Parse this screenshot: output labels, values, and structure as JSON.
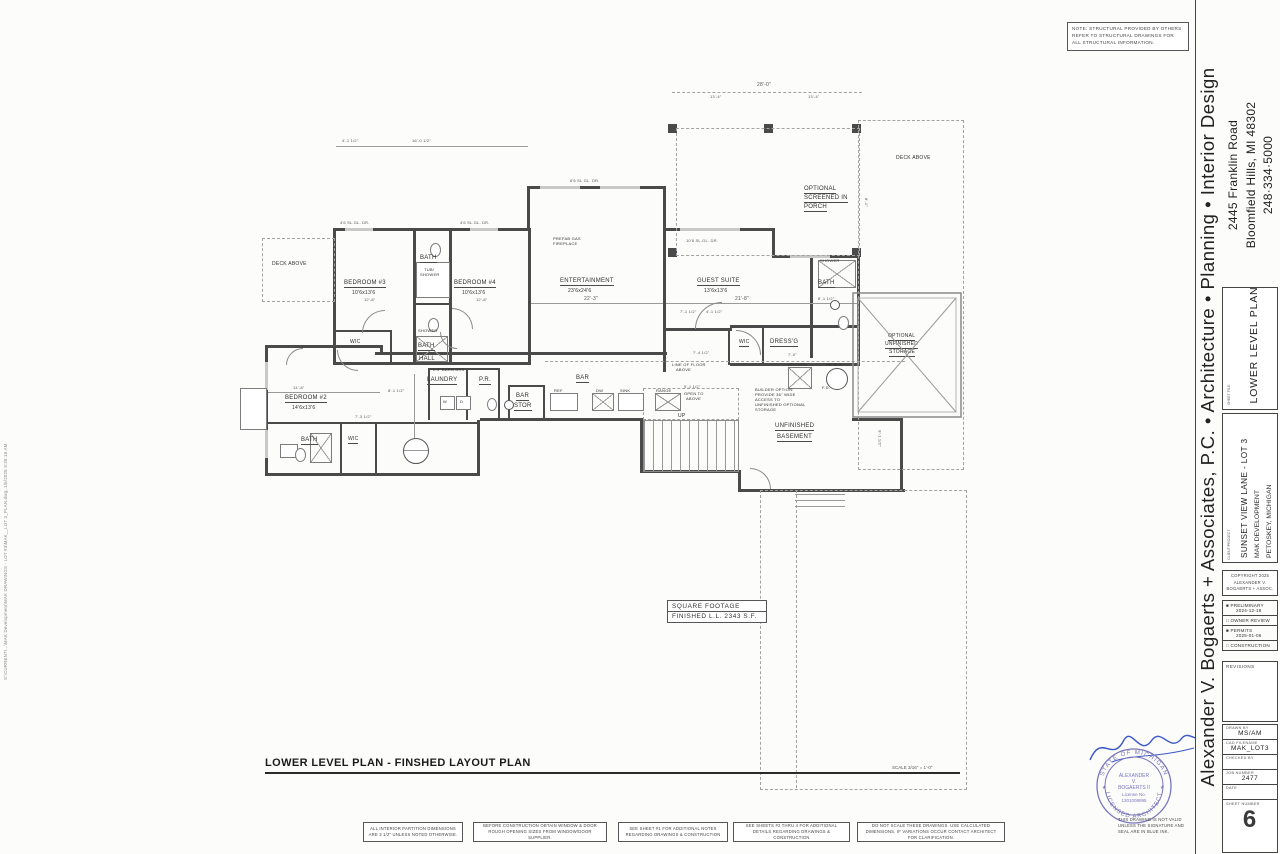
{
  "sheet": {
    "structural_note": "NOTE: STRUCTURAL PROVIDED BY OTHERS. REFER TO STRUCTURAL DRAWINGS FOR ALL STRUCTURAL INFORMATION.",
    "plan_title": "LOWER LEVEL PLAN - FINSHED LAYOUT PLAN",
    "scale_note": "SCALE 3/16\" = 1'-0\"",
    "file_path": "S:\\CURRENT\\...\\MAK Development\\MAK DRAWINGS - LOT #3\\MAK__LOT 3_PLAN.dwg, 1/6/2025 9:35:18 AM",
    "square_footage": {
      "line1": "SQUARE FOOTAGE",
      "line2": "FINISHED L.L.   2343 S.F."
    },
    "general_notes": [
      "ALL INTERIOR PARTITION DIMENSIONS ARE 3 1/2\" UNLESS NOTED OTHERWISE.",
      "BEFORE CONSTRUCTION OBTAIN WINDOW & DOOR ROUGH OPENING SIZES FROM WINDOW/DOOR SUPPLIER.",
      "SEE SHEET #1 FOR ADDITIONAL NOTES REGARDING DRAWINGS & CONSTRUCTION",
      "SEE SHEETS #2 THRU 4 FOR ADDITIONAL DETAILS REGARDING DRAWINGS & CONSTRUCTION",
      "DO NOT SCALE THESE DRAWINGS. USE CALCULATED DIMENSIONS. IF VARIATIONS OCCUR CONTACT ARCHITECT FOR CLARIFICATION."
    ]
  },
  "plan": {
    "labels": [
      {
        "text": "DECK ABOVE",
        "x": 272,
        "y": 262,
        "s": 5
      },
      {
        "text": "BEDROOM #3",
        "x": 344,
        "y": 280,
        "s": 6,
        "u": true
      },
      {
        "text": "10'6x13'6",
        "x": 352,
        "y": 291,
        "s": 5
      },
      {
        "text": "BATH",
        "x": 420,
        "y": 255,
        "s": 6,
        "u": true
      },
      {
        "text": "TUB/",
        "x": 424,
        "y": 268,
        "s": 4
      },
      {
        "text": "SHOWER",
        "x": 420,
        "y": 273,
        "s": 4
      },
      {
        "text": "BEDROOM #4",
        "x": 454,
        "y": 280,
        "s": 6,
        "u": true
      },
      {
        "text": "10'6x13'6",
        "x": 462,
        "y": 291,
        "s": 5
      },
      {
        "text": "WIC",
        "x": 350,
        "y": 340,
        "s": 5,
        "u": true
      },
      {
        "text": "SHOWER",
        "x": 418,
        "y": 329,
        "s": 4
      },
      {
        "text": "BATH",
        "x": 418,
        "y": 343,
        "s": 6,
        "u": true
      },
      {
        "text": "PREFAB GAS",
        "x": 553,
        "y": 237,
        "s": 4
      },
      {
        "text": "FIREPLACE",
        "x": 553,
        "y": 242,
        "s": 4
      },
      {
        "text": "ENTERTAINMENT",
        "x": 560,
        "y": 278,
        "s": 6,
        "u": true
      },
      {
        "text": "23'6x24'6",
        "x": 568,
        "y": 289,
        "s": 5
      },
      {
        "text": "GUEST SUITE",
        "x": 697,
        "y": 278,
        "s": 6,
        "u": true
      },
      {
        "text": "13'6x13'6",
        "x": 704,
        "y": 289,
        "s": 5
      },
      {
        "text": "SHOWER",
        "x": 820,
        "y": 259,
        "s": 4
      },
      {
        "text": "BATH",
        "x": 818,
        "y": 280,
        "s": 6,
        "u": true
      },
      {
        "text": "WIC",
        "x": 739,
        "y": 340,
        "s": 5,
        "u": true
      },
      {
        "text": "DRESS'G",
        "x": 770,
        "y": 339,
        "s": 6,
        "u": true
      },
      {
        "text": "OPTIONAL",
        "x": 804,
        "y": 186,
        "s": 6,
        "u": true
      },
      {
        "text": "SCREENED IN",
        "x": 804,
        "y": 195,
        "s": 6,
        "u": true
      },
      {
        "text": "PORCH",
        "x": 804,
        "y": 204,
        "s": 6,
        "u": true
      },
      {
        "text": "DECK ABOVE",
        "x": 896,
        "y": 156,
        "s": 5
      },
      {
        "text": "OPTIONAL",
        "x": 888,
        "y": 334,
        "s": 5,
        "u": true
      },
      {
        "text": "UNFINISHED",
        "x": 885,
        "y": 342,
        "s": 5,
        "u": true
      },
      {
        "text": "STORAGE",
        "x": 889,
        "y": 350,
        "s": 5,
        "u": true
      },
      {
        "text": "BEDROOM #2",
        "x": 285,
        "y": 395,
        "s": 6,
        "u": true
      },
      {
        "text": "14'6x13'6",
        "x": 292,
        "y": 406,
        "s": 5
      },
      {
        "text": "BATH",
        "x": 301,
        "y": 437,
        "s": 6,
        "u": true
      },
      {
        "text": "WIC",
        "x": 348,
        "y": 437,
        "s": 5,
        "u": true
      },
      {
        "text": "HALL",
        "x": 419,
        "y": 356,
        "s": 6,
        "u": true
      },
      {
        "text": "2-3' BARN DRS",
        "x": 433,
        "y": 368,
        "s": 4
      },
      {
        "text": "LAUNDRY",
        "x": 427,
        "y": 377,
        "s": 6,
        "u": true
      },
      {
        "text": "P.R.",
        "x": 479,
        "y": 377,
        "s": 6,
        "u": true
      },
      {
        "text": "BAR",
        "x": 576,
        "y": 375,
        "s": 6,
        "u": true
      },
      {
        "text": "BAR",
        "x": 516,
        "y": 393,
        "s": 6,
        "u": true
      },
      {
        "text": "STOR",
        "x": 514,
        "y": 403,
        "s": 6,
        "u": true
      },
      {
        "text": "REF",
        "x": 554,
        "y": 389,
        "s": 4
      },
      {
        "text": "DW",
        "x": 596,
        "y": 389,
        "s": 4
      },
      {
        "text": "SINK",
        "x": 620,
        "y": 389,
        "s": 4
      },
      {
        "text": "RANGE",
        "x": 656,
        "y": 389,
        "s": 4
      },
      {
        "text": "W",
        "x": 443,
        "y": 400,
        "s": 4
      },
      {
        "text": "D",
        "x": 460,
        "y": 400,
        "s": 4
      },
      {
        "text": "LINE OF FLOOR",
        "x": 672,
        "y": 363,
        "s": 4
      },
      {
        "text": "ABOVE",
        "x": 676,
        "y": 368,
        "s": 4
      },
      {
        "text": "OPEN TO",
        "x": 684,
        "y": 392,
        "s": 4
      },
      {
        "text": "ABOVE",
        "x": 686,
        "y": 397,
        "s": 4
      },
      {
        "text": "UP",
        "x": 678,
        "y": 414,
        "s": 5
      },
      {
        "text": "HE FURN",
        "x": 788,
        "y": 363,
        "s": 4
      },
      {
        "text": "HE W.H.",
        "x": 826,
        "y": 363,
        "s": 4
      },
      {
        "text": "F.D.",
        "x": 822,
        "y": 386,
        "s": 4
      },
      {
        "text": "BUILDER OPTION:",
        "x": 755,
        "y": 388,
        "s": 4
      },
      {
        "text": "PROVIDE 36\" WIDE",
        "x": 755,
        "y": 393,
        "s": 4
      },
      {
        "text": "ACCESS TO",
        "x": 755,
        "y": 398,
        "s": 4
      },
      {
        "text": "UNFINISHED OPTIONAL",
        "x": 755,
        "y": 403,
        "s": 4
      },
      {
        "text": "STORAGE",
        "x": 755,
        "y": 408,
        "s": 4
      },
      {
        "text": "UNFINISHED",
        "x": 775,
        "y": 423,
        "s": 6,
        "u": true
      },
      {
        "text": "BASEMENT",
        "x": 777,
        "y": 434,
        "s": 6,
        "u": true
      }
    ],
    "dimensions": [
      {
        "text": "28'-0\"",
        "x": 757,
        "y": 82,
        "s": 5
      },
      {
        "text": "13'-4\"",
        "x": 710,
        "y": 94,
        "s": 4
      },
      {
        "text": "13'-4\"",
        "x": 808,
        "y": 94,
        "s": 4
      },
      {
        "text": "4'-1 1/2\"",
        "x": 342,
        "y": 138,
        "s": 4
      },
      {
        "text": "16'-0 1/2\"",
        "x": 412,
        "y": 138,
        "s": 4
      },
      {
        "text": "4'6 SL.GL. DR.",
        "x": 340,
        "y": 220,
        "s": 4
      },
      {
        "text": "4'6 SL.GL. DR.",
        "x": 460,
        "y": 220,
        "s": 4
      },
      {
        "text": "8'6 SL.GL. DR.",
        "x": 570,
        "y": 178,
        "s": 4
      },
      {
        "text": "10'6 SL.GL. DR.",
        "x": 686,
        "y": 238,
        "s": 4
      },
      {
        "text": "22'-3\"",
        "x": 584,
        "y": 296,
        "s": 5
      },
      {
        "text": "21'-8\"",
        "x": 735,
        "y": 296,
        "s": 5
      },
      {
        "text": "8'-1 1/2\"",
        "x": 818,
        "y": 296,
        "s": 4
      },
      {
        "text": "7'-1 1/2\"",
        "x": 680,
        "y": 309,
        "s": 4
      },
      {
        "text": "4'-1 1/2\"",
        "x": 706,
        "y": 309,
        "s": 4
      },
      {
        "text": "7'-4 1/2\"",
        "x": 693,
        "y": 350,
        "s": 4
      },
      {
        "text": "7'-0\"",
        "x": 788,
        "y": 352,
        "s": 4
      },
      {
        "text": "12'-8\"",
        "x": 364,
        "y": 297,
        "s": 4
      },
      {
        "text": "12'-8\"",
        "x": 476,
        "y": 297,
        "s": 4
      },
      {
        "text": "14'-8\"",
        "x": 293,
        "y": 385,
        "s": 4
      },
      {
        "text": "8'-1 1/2\"",
        "x": 388,
        "y": 388,
        "s": 4
      },
      {
        "text": "7'-3 1/2\"",
        "x": 355,
        "y": 414,
        "s": 4
      },
      {
        "text": "5'-1 1/2\"",
        "x": 684,
        "y": 384,
        "s": 4
      },
      {
        "text": "8'-1 1/2\"",
        "x": 872,
        "y": 436,
        "s": 4,
        "rot": 90
      },
      {
        "text": "8'-1\"",
        "x": 862,
        "y": 200,
        "s": 4,
        "rot": 90
      }
    ]
  },
  "title_block": {
    "firm_name": "Alexander V. Bogaerts + Associates, P.C.  •  Architecture  •  Planning  •  Interior Design",
    "address_line1": "2445 Franklin Road",
    "address_line2": "Bloomfield Hills, MI 48302",
    "phone": "248·334·5000",
    "sheet_file_label": "SHEET FILE",
    "sheet_file": "LOWER LEVEL PLAN",
    "client_label": "CLIENT/PROJECT",
    "project_name": "SUNSET VIEW LANE - LOT 3",
    "project_sub1": "MAK DEVELOPMENT",
    "project_sub2": "PETOSKEY, MICHIGAN",
    "copyright_line1": "COPYRIGHT 2025",
    "copyright_line2": "ALEXANDER V.",
    "copyright_line3": "BOGAERTS + ASSOC.",
    "milestones": [
      {
        "checked": true,
        "label": "PRELIMINARY",
        "date": "2024-12-18"
      },
      {
        "checked": false,
        "label": "OWNER REVIEW",
        "date": ""
      },
      {
        "checked": true,
        "label": "PERMITS",
        "date": "2025-01-06"
      },
      {
        "checked": false,
        "label": "CONSTRUCTION",
        "date": ""
      }
    ],
    "revisions_label": "REVISIONS",
    "fields": [
      {
        "label": "DRAWN BY",
        "value": "MS/AM"
      },
      {
        "label": "CAD FILENAME",
        "value": "MAK_LOT3"
      },
      {
        "label": "CHECKED BY",
        "value": ""
      },
      {
        "label": "JOB NUMBER",
        "value": "2477"
      },
      {
        "label": "DATE",
        "value": ""
      }
    ],
    "sheet_number_label": "SHEET NUMBER",
    "sheet_number": "6"
  },
  "stamp": {
    "ring_top": "STATE OF MICHIGAN",
    "ring_bottom": "LICENSED ARCHITECT",
    "name1": "ALEXANDER",
    "name2": "V.",
    "name3": "BOGAERTS II",
    "lic1": "License No.",
    "lic2": "1301008995",
    "seal_color": "#7a76bb",
    "signature_color": "#3c57c6",
    "blue_ink_note": "THIS DRAWING IS NOT VALID UNLESS THE SIGNATURE AND SEAL ARE IN BLUE INK."
  }
}
